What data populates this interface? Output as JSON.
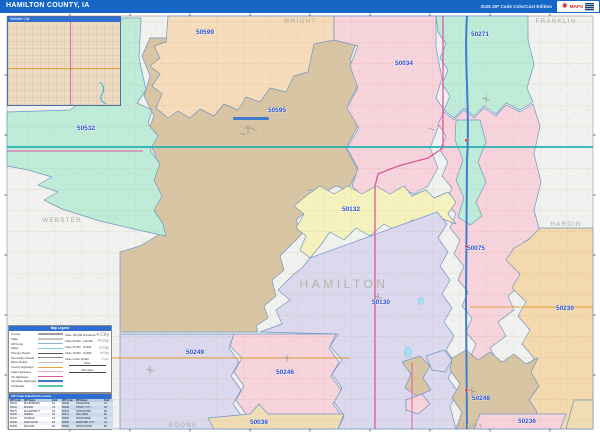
{
  "header": {
    "title": "HAMILTON COUNTY, IA",
    "edition": "2026 ZIP Code ColorCast Edition",
    "brand": "MAPS"
  },
  "inset": {
    "title": "Webster City"
  },
  "palette": {
    "peach": "#f6dcba",
    "tan": "#d8c5a4",
    "mint": "#bfecd9",
    "pink": "#f7d3dc",
    "yellow": "#f6f2bd",
    "lavender": "#dcd8ee",
    "orange_tan": "#f3d9ad",
    "bottom_tan": "#f0ddb6",
    "outside": "#f1f1ef",
    "water": "#a5dff2",
    "road_teal": "#25b2b0",
    "road_blue": "#3f7cd0",
    "road_magenta": "#e0559e",
    "road_orange": "#e5a33c"
  },
  "map": {
    "counties": [
      "WRIGHT",
      "FRANKLIN",
      "HARDIN",
      "WEBSTER",
      "BOONE",
      "STORY",
      "HAMILTON"
    ],
    "zips": [
      "50599",
      "50595",
      "50532",
      "50034",
      "50271",
      "50132",
      "50075",
      "50130",
      "50230",
      "50249",
      "50246",
      "50248",
      "50036",
      "50236"
    ]
  },
  "legend": {
    "title": "Map Legend",
    "items": [
      {
        "label": "County",
        "color": "#9d9d9d",
        "h": 2.2
      },
      {
        "label": "State",
        "color": "#c4c4c4",
        "h": 1.8
      },
      {
        "label": "ZIP Code",
        "color": "#8fb0d0",
        "h": 1.4
      },
      {
        "label": "Water",
        "color": "#7fd4ea",
        "h": 1.8
      },
      {
        "label": "Primary Roads",
        "color": "#555555",
        "h": 1.2
      },
      {
        "label": "Secondary Roads",
        "color": "#8a8a8a",
        "h": 1.0
      },
      {
        "label": "Minor Roads",
        "color": "#c0c0c0",
        "h": 0.8
      },
      {
        "label": "County Highways",
        "color": "#e5a33c",
        "h": 1.2
      },
      {
        "label": "State Highways",
        "color": "#f0aec6",
        "h": 1.2
      },
      {
        "label": "US Highways",
        "color": "#e0559e",
        "h": 1.2
      },
      {
        "label": "Interstate Highways",
        "color": "#3f7cd0",
        "h": 1.8
      },
      {
        "label": "Toll Roads",
        "color": "#58c898",
        "h": 1.2
      }
    ],
    "city_icon": "City",
    "cities": [
      "Cities 150,000 and Above",
      "Cities 50,000 - 149,999",
      "Cities 25,000 - 49,999",
      "Cities 10,000 - 24,999",
      "Cities Under 10,000"
    ],
    "scales": [
      "Miles",
      "Kilometers"
    ]
  },
  "index_table": {
    "title": "ZIP Code Index/Grid Locator",
    "columns": [
      "ZIP Code",
      "ZIP Name",
      "Grid"
    ],
    "rows": [
      [
        "50034",
        "BLAIRSBURG",
        "D1"
      ],
      [
        "50036",
        "BOONE",
        "C4"
      ],
      [
        "50075",
        "ELLSWORTH",
        "D2"
      ],
      [
        "50130",
        "JEWELL",
        "D3"
      ],
      [
        "50132",
        "KAMRAR",
        "C2"
      ],
      [
        "50230",
        "RADCLIFFE",
        "E3"
      ],
      [
        "50236",
        "ROLAND",
        "E4"
      ],
      [
        "50246",
        "STANHOPE",
        "C4"
      ],
      [
        "50248",
        "STORY CITY",
        "D4"
      ],
      [
        "50249",
        "STRATFORD",
        "B4"
      ],
      [
        "50271",
        "WILLIAMS",
        "E1"
      ],
      [
        "50532",
        "DUNCOMBE",
        "A2"
      ],
      [
        "50595",
        "WEBSTER CITY",
        "C1"
      ],
      [
        "50599",
        "WOOLSTOCK",
        "B1"
      ]
    ]
  }
}
